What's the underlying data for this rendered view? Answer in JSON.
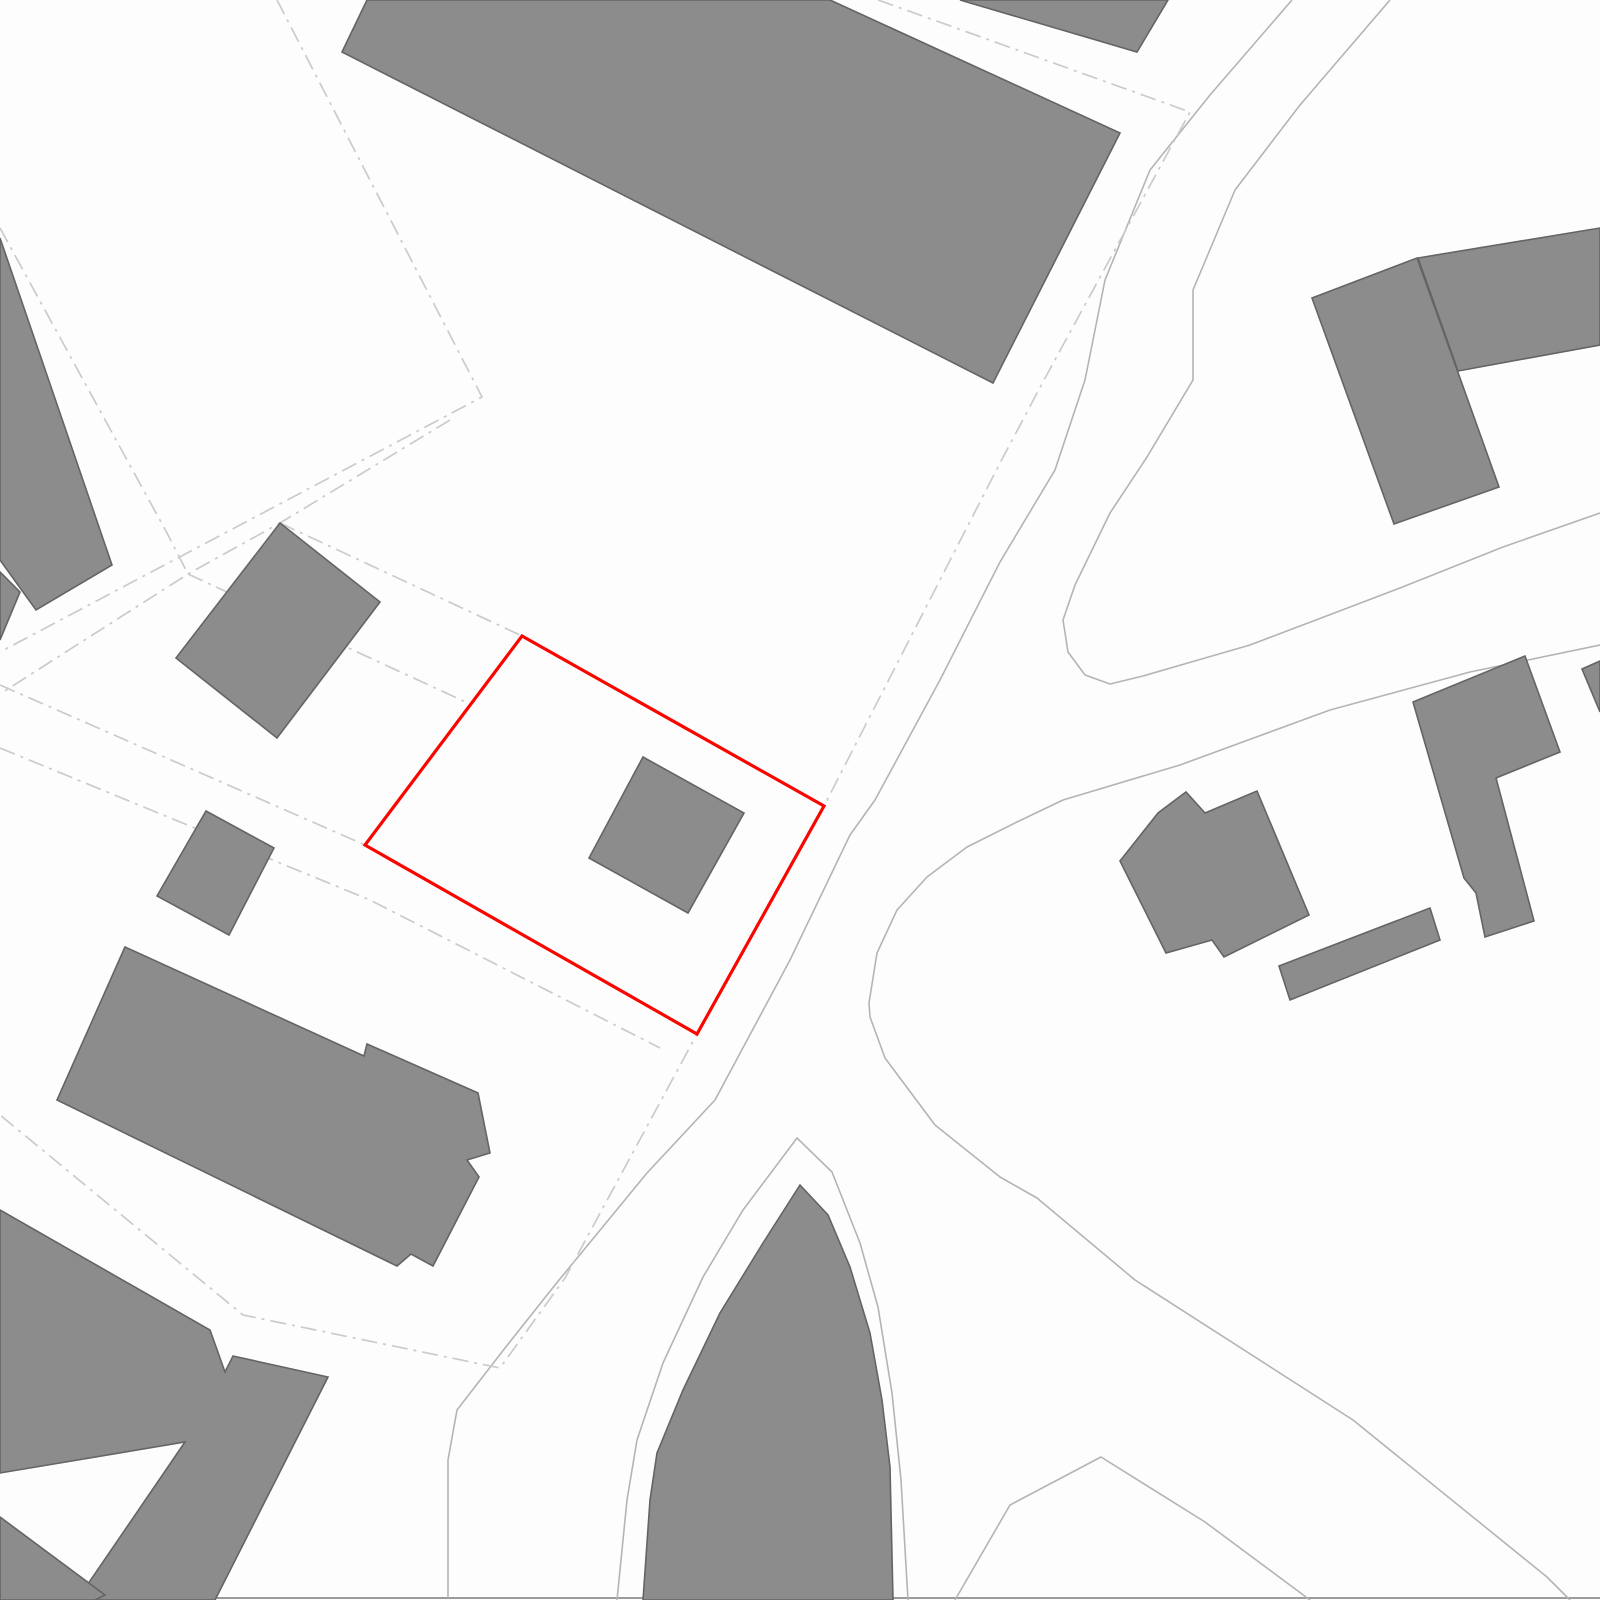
{
  "map": {
    "canvas": {
      "width": 1600,
      "height": 1600,
      "background": "#fdfdfd"
    },
    "colors": {
      "building_fill": "#8c8c8c",
      "building_stroke": "#646464",
      "road_line": "#b4b4b4",
      "baseline": "#9b9b9b",
      "boundary_dash": "#cbcbcb",
      "highlight_parcel": "#f90600"
    },
    "roads": [
      {
        "name": "road-west-edge",
        "points": "1292,0 1210,95 1150,170 1105,280 1085,380 1055,470 1000,562 940,680 875,800 850,835 790,960 715,1100 647,1173 555,1285 505,1348 457,1410 448,1460 448,1598"
      },
      {
        "name": "road-east-edge-teardrop",
        "points": "1390,0 1300,105 1235,190 1193,290 1193,380 1147,457 1110,513 1075,585 1063,620 1068,652 1085,675 1110,684 1143,676 1250,645 1337,612 1400,588 1503,547 1600,513"
      },
      {
        "name": "road-south-edge-junction-wrap",
        "points": "1600,645 1470,672 1330,710 1180,765 1063,800 1017,822 967,847 927,877 897,910 877,953 869,1003 870,1017 885,1058 935,1125 1000,1177 1037,1198 1135,1280 1353,1420 1547,1577 1570,1600"
      },
      {
        "name": "island-outer-kerb",
        "points": "617,1600 627,1500 637,1440 663,1363 703,1277 743,1210 797,1138 832,1172 860,1243 878,1307 892,1393 901,1480 908,1600"
      },
      {
        "name": "southeast-arch-kerb",
        "points": "955,1600 1010,1505 1101,1457 1205,1522 1310,1600"
      }
    ],
    "baseline": {
      "name": "bottom-edge-line",
      "points": "213,1598 1600,1598"
    },
    "boundaries": [
      {
        "name": "boundary-northwest",
        "points": "277,0 482,397 0,652"
      },
      {
        "name": "boundary-northwest-inner",
        "points": "450,420 280,523 188,574 0,694"
      },
      {
        "name": "boundary-west-upper",
        "points": "0,228 167,533 188,574"
      },
      {
        "name": "boundary-to-parcel-west-edge",
        "points": "188,574 470,704"
      },
      {
        "name": "boundary-to-parcel-top-corner",
        "points": "280,523 522,636"
      },
      {
        "name": "boundary-track-upper",
        "points": "0,685 365,845"
      },
      {
        "name": "boundary-track-lower",
        "points": "0,748 370,900 660,1048"
      },
      {
        "name": "boundary-along-road",
        "points": "878,0 1190,112 1044,380 1000,463 824,806 697,1034 565,1278 500,1368 243,1315 0,1115"
      }
    ],
    "buildings": [
      {
        "name": "building-north-large",
        "points": "342,52 367,0 830,0 1120,133 993,383"
      },
      {
        "name": "building-north-wedge",
        "points": "960,0 1168,0 1137,52"
      },
      {
        "name": "building-northeast-tall",
        "points": "1312,298 1417,258 1499,487 1394,524"
      },
      {
        "name": "building-northeast-arm",
        "points": "1418,258 1600,228 1600,345 1458,371"
      },
      {
        "name": "building-east-cross",
        "points": "1120,861 1158,813 1186,792 1205,813 1257,791 1309,915 1224,957 1212,940 1166,953"
      },
      {
        "name": "building-east-bar",
        "points": "1279,966 1430,908 1440,940 1290,1000"
      },
      {
        "name": "building-east-notched",
        "points": "1413,702 1525,656 1560,752 1496,778 1534,921 1485,937 1476,893 1464,878"
      },
      {
        "name": "building-right-edge-sliver",
        "points": "1582,669 1600,661 1600,712"
      },
      {
        "name": "building-on-site-parcel",
        "points": "643,757 744,813 688,913 589,858"
      },
      {
        "name": "building-west-small",
        "points": "280,523 380,602 277,738 176,658"
      },
      {
        "name": "building-west-edge-upper",
        "points": "0,238 112,565 36,610 0,560"
      },
      {
        "name": "building-west-edge-lower",
        "points": "0,572 20,592 0,640"
      },
      {
        "name": "building-west-tiny",
        "points": "206,811 274,848 229,935 157,896"
      },
      {
        "name": "building-southwest-long",
        "points": "125,947 364,1056 367,1044 478,1093 490,1153 467,1160 479,1177 433,1266 411,1254 397,1266 57,1100"
      },
      {
        "name": "building-southwest-corner",
        "points": "0,1210 210,1330 225,1372 233,1356 328,1377 215,1600 77,1600 185,1442 0,1473"
      },
      {
        "name": "building-corner-triangle",
        "points": "0,1517 105,1595 95,1600 0,1600"
      },
      {
        "name": "building-south-island",
        "points": "643,1600 650,1500 657,1453 683,1390 720,1313 763,1243 800,1185 828,1215 850,1267 870,1333 882,1400 890,1467 893,1600"
      }
    ],
    "parcel": {
      "name": "highlighted-site-parcel",
      "points": "522,636 824,806 697,1034 365,845"
    }
  }
}
